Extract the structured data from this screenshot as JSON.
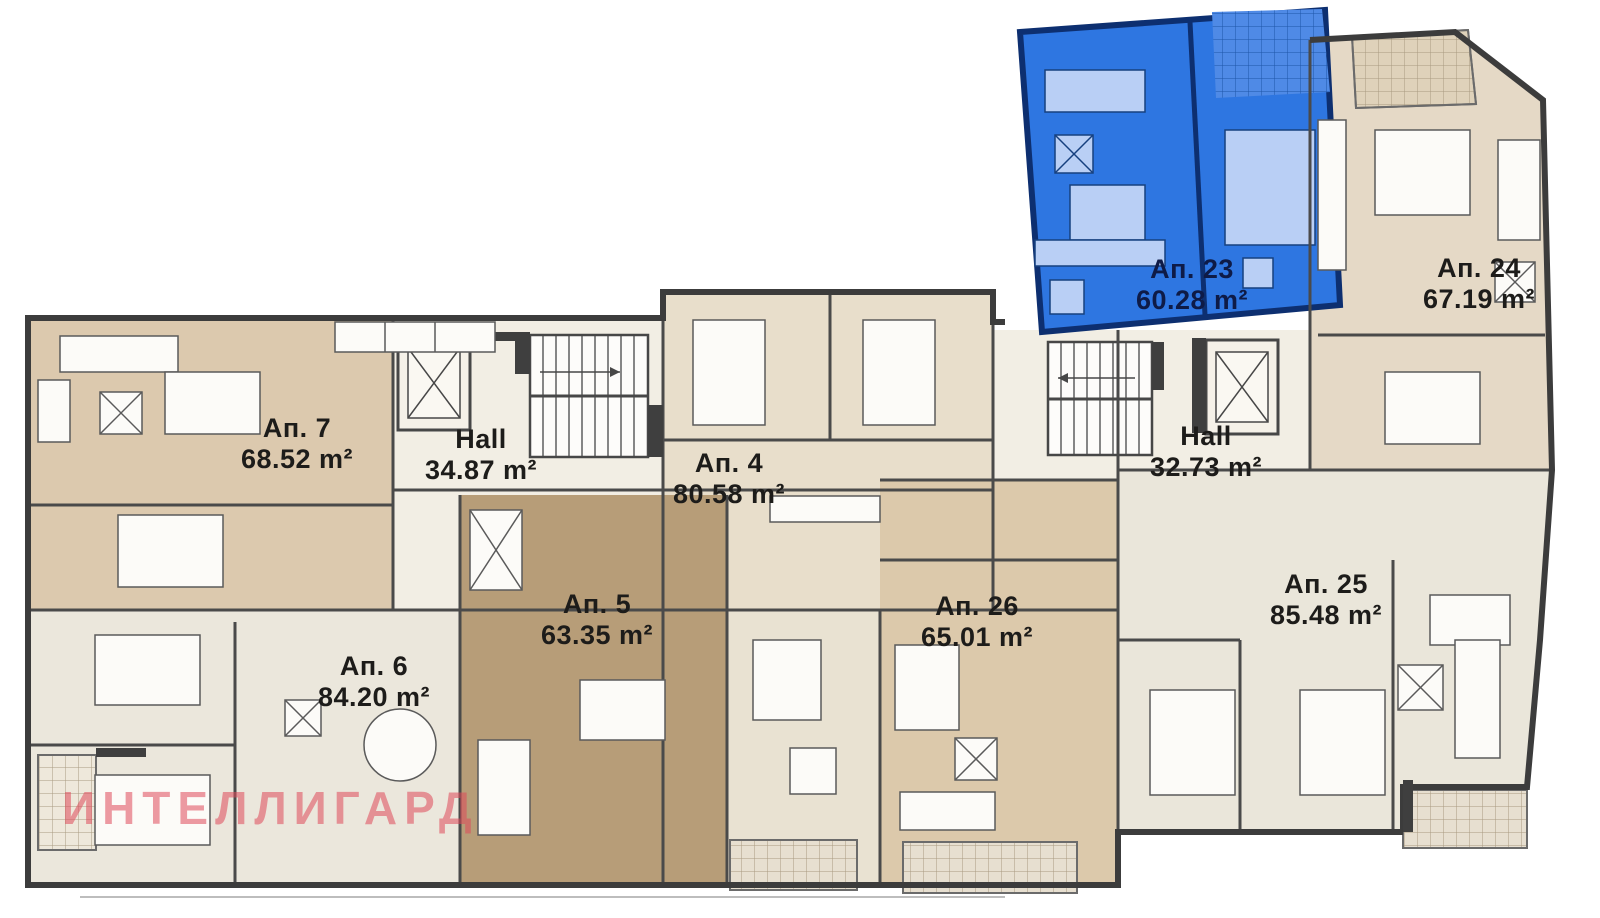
{
  "watermark": "ИНТЕЛЛИГАРД",
  "units": [
    {
      "name": "Ап. 7",
      "area": "68.52 m²",
      "highlighted": false
    },
    {
      "name": "Hall",
      "area": "34.87 m²",
      "highlighted": false
    },
    {
      "name": "Ап. 4",
      "area": "80.58 m²",
      "highlighted": false
    },
    {
      "name": "Ап. 23",
      "area": "60.28 m²",
      "highlighted": true
    },
    {
      "name": "Ап. 24",
      "area": "67.19 m²",
      "highlighted": false
    },
    {
      "name": "Hall",
      "area": "32.73 m²",
      "highlighted": false
    },
    {
      "name": "Ап. 5",
      "area": "63.35 m²",
      "highlighted": false
    },
    {
      "name": "Ап. 6",
      "area": "84.20 m²",
      "highlighted": false
    },
    {
      "name": "Ап. 26",
      "area": "65.01 m²",
      "highlighted": false
    },
    {
      "name": "Ап. 25",
      "area": "85.48 m²",
      "highlighted": false
    }
  ],
  "colors": {
    "highlight_fill": "#2e76e1",
    "highlight_wall": "#0d2f70",
    "highlight_furniture": "#b9cff5",
    "wall": "#3e3e3e",
    "watermark_red": "#de495a",
    "unit_tan": "#dcc9ae",
    "unit_beige": "#e8decb",
    "unit_cream": "#f2eee4",
    "unit_brown": "#b79d78",
    "unit_light": "#ebe7dc"
  },
  "icons": {
    "elevator": "elevator-x-icon",
    "stairs": "stairs-icon",
    "coffee_table": "x-table-icon"
  }
}
